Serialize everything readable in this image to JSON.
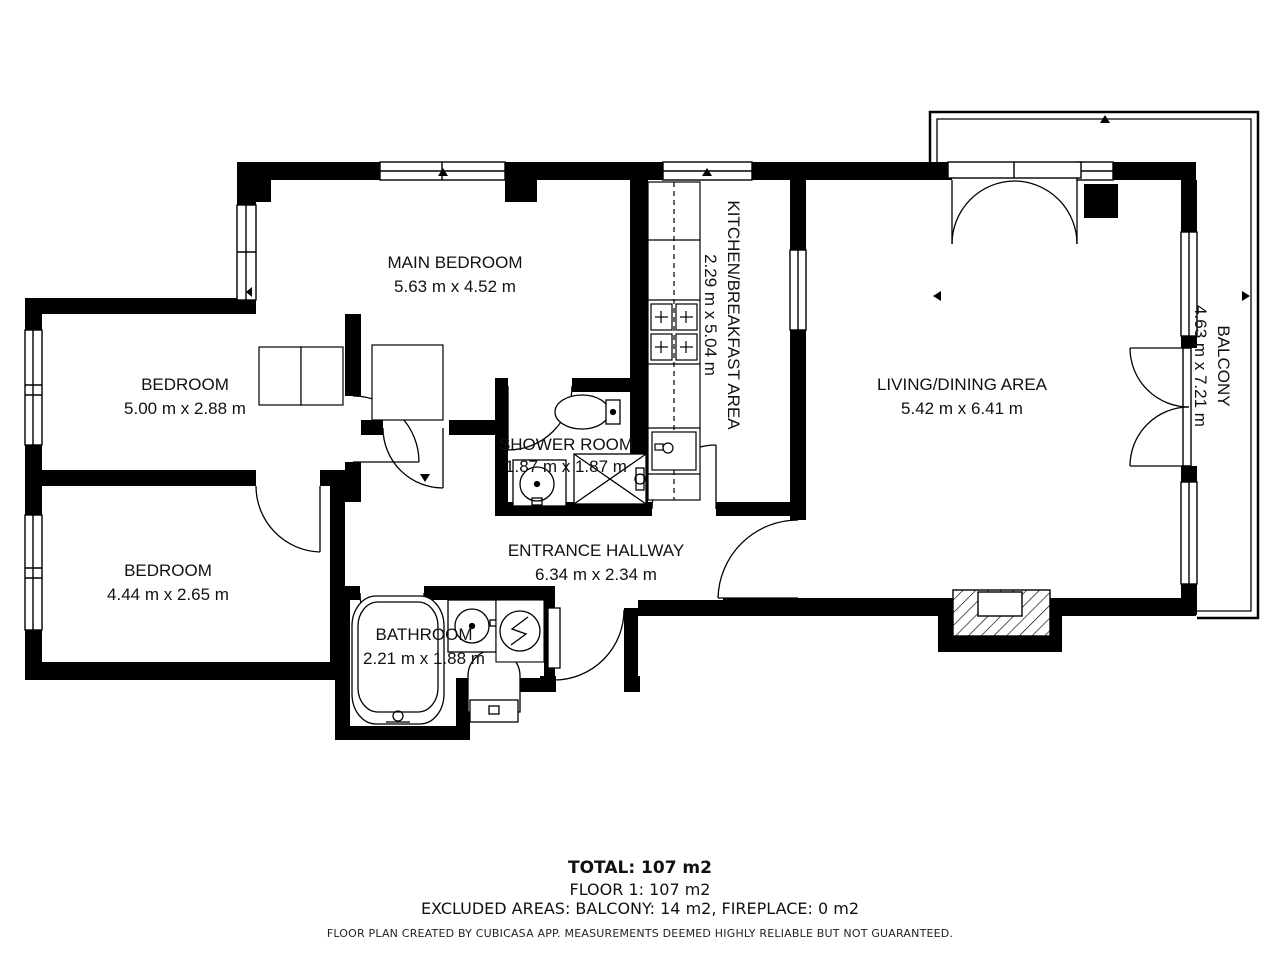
{
  "floorplan": {
    "rooms": [
      {
        "id": "main-bedroom",
        "name": "MAIN BEDROOM",
        "dimensions": "5.63 m x 4.52 m"
      },
      {
        "id": "bedroom-1",
        "name": "BEDROOM",
        "dimensions": "5.00 m x 2.88 m"
      },
      {
        "id": "bedroom-2",
        "name": "BEDROOM",
        "dimensions": "4.44 m x 2.65 m"
      },
      {
        "id": "kitchen",
        "name": "KITCHEN/BREAKFAST AREA",
        "dimensions": "2.29 m x 5.04 m"
      },
      {
        "id": "living-dining",
        "name": "LIVING/DINING AREA",
        "dimensions": "5.42 m x 6.41 m"
      },
      {
        "id": "balcony",
        "name": "BALCONY",
        "dimensions": "4.63 m x 7.21 m"
      },
      {
        "id": "shower-room",
        "name": "SHOWER ROOM",
        "dimensions": "1.87 m x 1.87 m"
      },
      {
        "id": "entrance-hallway",
        "name": "ENTRANCE HALLWAY",
        "dimensions": "6.34 m x 2.34 m"
      },
      {
        "id": "bathroom",
        "name": "BATHROOM",
        "dimensions": "2.21 m x 1.88 m"
      }
    ],
    "summary": {
      "total": "TOTAL: 107 m2",
      "floor": "FLOOR 1: 107 m2",
      "excluded": "EXCLUDED AREAS: BALCONY: 14 m2, FIREPLACE: 0 m2"
    },
    "disclaimer": "FLOOR PLAN CREATED BY CUBICASA APP. MEASUREMENTS DEEMED HIGHLY RELIABLE BUT NOT GUARANTEED.",
    "colors": {
      "wall": "#000000",
      "background": "#ffffff"
    }
  }
}
